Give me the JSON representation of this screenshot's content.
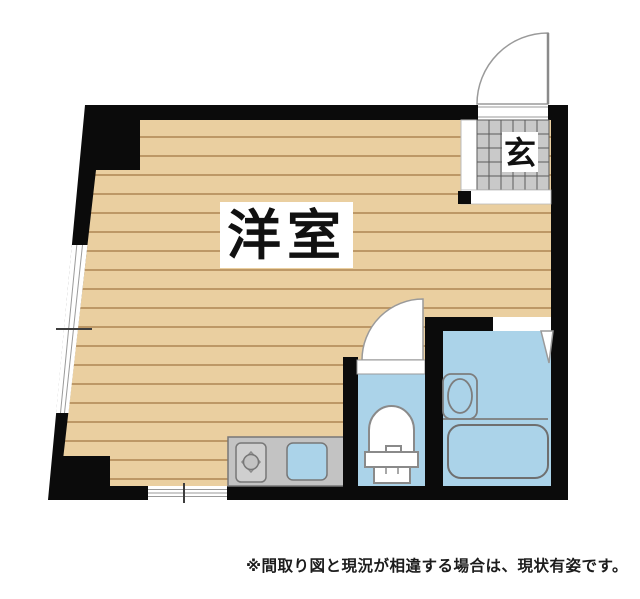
{
  "floor_plan": {
    "room_label": "洋室",
    "entrance_label": "玄",
    "disclaimer": "※間取り図と現況が相違する場合は、現状有姿です。",
    "features": [
      "entrance-door-swing",
      "entrance-tile-floor",
      "entrance-step",
      "main-room-wood-floor",
      "left-slanted-wall-window",
      "bottom-window",
      "kitchen-counter",
      "stove-burner",
      "kitchen-sink",
      "toilet-room",
      "toilet-door-swing",
      "toilet-fixture",
      "bathroom",
      "bathroom-door",
      "bathroom-sink",
      "bathtub"
    ]
  },
  "colors": {
    "wall": "#0b0b0b",
    "floor": "#eacfa0",
    "floor_stripe": "#bd9866",
    "wet_area": "#abd3e9",
    "tile": "#c9c9c9",
    "counter": "#c3c3c3",
    "burner": "#cfcfcf",
    "white": "#ffffff"
  }
}
